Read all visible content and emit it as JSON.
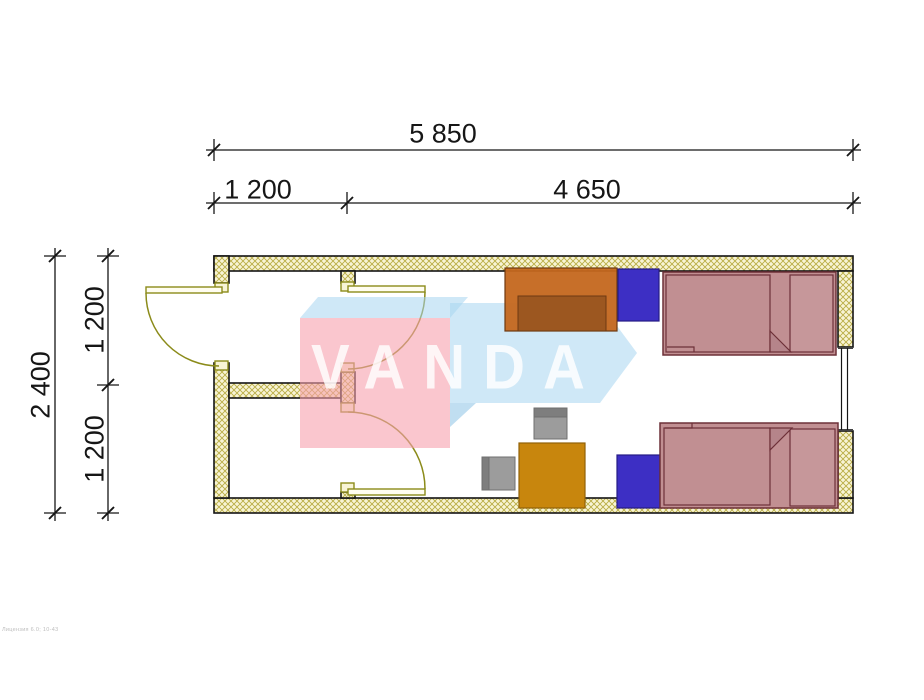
{
  "drawing": {
    "type": "floor-plan",
    "watermark": {
      "text": "VANDA",
      "front_color": "rgba(247,160,173,0.60)",
      "side_color": "rgba(168,214,240,0.55)"
    },
    "dimensions": {
      "top_total": "5 850",
      "top_segment_left": "1 200",
      "top_segment_right": "4 650",
      "left_total": "2 400",
      "left_room_upper": "1 200",
      "left_room_lower": "1 200"
    },
    "furniture": [
      "wardrobe",
      "nightstand",
      "single bed",
      "nightstand",
      "single bed",
      "desk",
      "chair",
      "chair"
    ],
    "colors": {
      "wall_hatch_bg": "#f8f4d5",
      "wall_hatch_line": "#b9ad45",
      "wall_outline": "#141414",
      "door": "#8b8b1a",
      "bed_fill": "#c18f92",
      "bed_outline": "#6d3038",
      "wardrobe": "#c4671d",
      "wardrobe_inner": "#97541f",
      "nightstand": "#3d2fc4",
      "desk": "#c8860d",
      "chair": "#9c9c9c"
    },
    "footer_note": "Лицензия 6.0; 10-43"
  }
}
